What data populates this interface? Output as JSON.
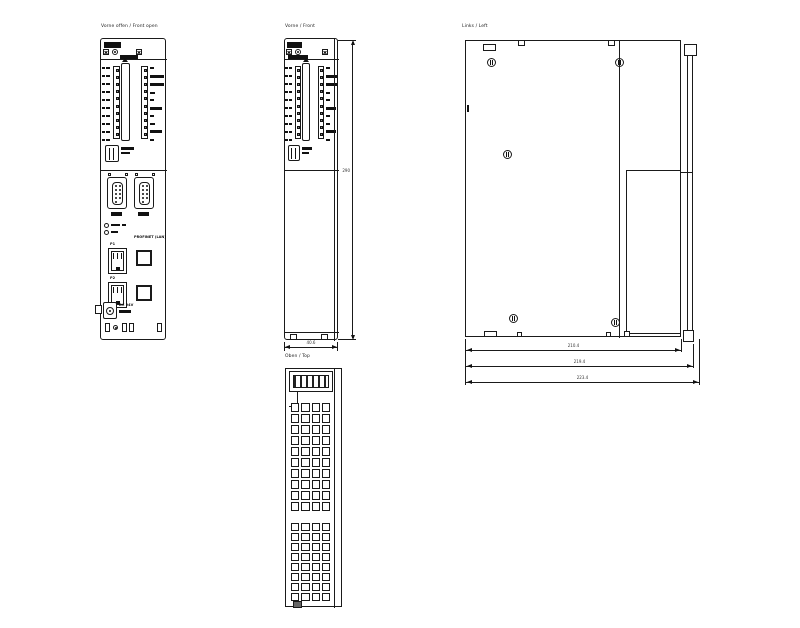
{
  "page": {
    "background": "#ffffff",
    "line_color": "#1a1a1a"
  },
  "views": {
    "front_open": {
      "title": "Vorne offen / Front open"
    },
    "front": {
      "title": "Vorne / Front",
      "height_dim": "290",
      "width_dim": "40.6"
    },
    "top": {
      "title": "Oben / Top"
    },
    "left": {
      "title": "Links / Left",
      "dims": {
        "body_depth": "210.4",
        "with_rail": "219.4",
        "overall": "223.4"
      }
    }
  },
  "labels": {
    "lan_port_group": "PROFINET (LAN)",
    "port1": "P1",
    "port2": "P2",
    "power": "DC 24V"
  }
}
